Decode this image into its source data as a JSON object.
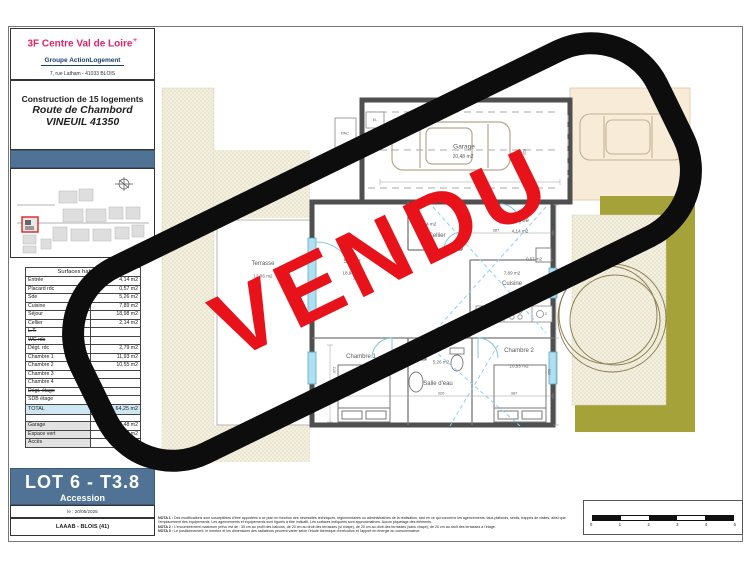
{
  "header": {
    "brand": "3F Centre Val de Loire",
    "brand_mark": "✳",
    "group": "Groupe ActionLogement",
    "address": "7, rue Latham - 41033 BLOIS",
    "project_line1": "Construction de 15 logements",
    "project_line2": "Route de Chambord",
    "project_line3": "VINEUIL 41350"
  },
  "surfaces": {
    "title": "Surfaces habitables",
    "rows": [
      {
        "label": "Entrée",
        "value": "4,14 m2",
        "struck": false
      },
      {
        "label": "Placard rdc",
        "value": "0,57 m2",
        "struck": false
      },
      {
        "label": "Sde",
        "value": "5,26 m2",
        "struck": false
      },
      {
        "label": "Cuisine",
        "value": "7,89 m2",
        "struck": false
      },
      {
        "label": "Séjour",
        "value": "18,98 m2",
        "struck": false
      },
      {
        "label": "Cellier",
        "value": "2,14 m2",
        "struck": false
      },
      {
        "label": "L.T.",
        "value": "",
        "struck": true
      },
      {
        "label": "WC rdc",
        "value": "",
        "struck": true
      },
      {
        "label": "Dégt. rdc",
        "value": "2,79 m2",
        "struck": false
      },
      {
        "label": "Chambre 1",
        "value": "11,93 m2",
        "struck": false
      },
      {
        "label": "Chambre 2",
        "value": "10,55 m2",
        "struck": false
      },
      {
        "label": "Chambre 3",
        "value": "",
        "struck": false
      },
      {
        "label": "Chambre 4",
        "value": "",
        "struck": false
      },
      {
        "label": "Dégt. étage",
        "value": "",
        "struck": true
      },
      {
        "label": "SDB étage",
        "value": "",
        "struck": false
      },
      {
        "label": "WC étage",
        "value": "",
        "struck": false
      },
      {
        "label": "",
        "value": "",
        "struck": false
      }
    ],
    "total_label": "TOTAL",
    "total_value": "64,25 m2",
    "annex": [
      {
        "label": "Garage",
        "value": "20,48 m2"
      },
      {
        "label": "Espace vert",
        "value": "82,6 m2"
      },
      {
        "label": "Accès",
        "value": "19,38 m2"
      }
    ]
  },
  "lot": {
    "title": "LOT 6 - T3.8",
    "subtitle": "Accession",
    "date": "le : 20/05/2025",
    "ref": "LAAAB - BLOIS (41)"
  },
  "stamp": {
    "text": "VENDU",
    "text_color": "#e8121a",
    "border_color": "#0d0d0d"
  },
  "plan": {
    "labels": [
      {
        "id": "garage-name",
        "text": "Garage",
        "x": 464,
        "y": 147,
        "size": 6.5
      },
      {
        "id": "garage-area",
        "text": "20,48 m2",
        "x": 463,
        "y": 157,
        "size": 5
      },
      {
        "id": "pac",
        "text": "PAC",
        "x": 345,
        "y": 133,
        "size": 4
      },
      {
        "id": "el",
        "text": "EL",
        "x": 375,
        "y": 120,
        "size": 3.5
      },
      {
        "id": "cellier-area",
        "text": "2,14 m2",
        "x": 428,
        "y": 224,
        "size": 4.6
      },
      {
        "id": "cellier-name",
        "text": "Cellier",
        "x": 437,
        "y": 236,
        "size": 6
      },
      {
        "id": "entree-name",
        "text": "Entrée",
        "x": 520,
        "y": 221,
        "size": 6
      },
      {
        "id": "entree-area",
        "text": "4,14 m2",
        "x": 520,
        "y": 231,
        "size": 4.6
      },
      {
        "id": "placard-area",
        "text": "0,57 m2",
        "x": 534,
        "y": 259,
        "size": 4.4
      },
      {
        "id": "cuisine-area",
        "text": "7,89 m2",
        "x": 512,
        "y": 273,
        "size": 4.6
      },
      {
        "id": "cuisine-name",
        "text": "Cuisine",
        "x": 512,
        "y": 284,
        "size": 6
      },
      {
        "id": "sejour-name",
        "text": "Séjour",
        "x": 352,
        "y": 262,
        "size": 6
      },
      {
        "id": "sejour-area",
        "text": "18,98 m2",
        "x": 352,
        "y": 273,
        "size": 4.6
      },
      {
        "id": "terrasse-name",
        "text": "Terrasse",
        "x": 263,
        "y": 264,
        "size": 6
      },
      {
        "id": "terrasse-area",
        "text": "12,06 m2",
        "x": 263,
        "y": 276,
        "size": 4.6
      },
      {
        "id": "degt-area",
        "text": "2,79 m2",
        "x": 443,
        "y": 330,
        "size": 4.6
      },
      {
        "id": "degt-name",
        "text": "Dégt.",
        "x": 443,
        "y": 341,
        "size": 6
      },
      {
        "id": "chambre1-name",
        "text": "Chambre 1",
        "x": 361,
        "y": 357,
        "size": 6
      },
      {
        "id": "chambre1-area",
        "text": "11,93 m2",
        "x": 359,
        "y": 377,
        "size": 4.6
      },
      {
        "id": "sde-area",
        "text": "5,26 m2",
        "x": 441,
        "y": 362,
        "size": 4.6
      },
      {
        "id": "sde-name",
        "text": "Salle d'eau",
        "x": 438,
        "y": 384,
        "size": 6
      },
      {
        "id": "chambre2-name",
        "text": "Chambre 2",
        "x": 519,
        "y": 351,
        "size": 6
      },
      {
        "id": "chambre2-area",
        "text": "10,55 m2",
        "x": 519,
        "y": 366,
        "size": 4.6
      },
      {
        "id": "appl-r",
        "text": "R",
        "x": 482,
        "y": 314,
        "size": 3.5
      },
      {
        "id": "appl-lv",
        "text": "LV",
        "x": 496,
        "y": 314,
        "size": 3.5
      },
      {
        "id": "appl-c",
        "text": "C",
        "x": 546,
        "y": 314,
        "size": 3.5
      },
      {
        "id": "dim-628",
        "text": "628",
        "x": 478,
        "y": 177,
        "size": 4
      },
      {
        "id": "dim-387-top",
        "text": "387",
        "x": 496,
        "y": 230,
        "size": 4
      },
      {
        "id": "dim-326",
        "text": "326",
        "x": 346,
        "y": 393,
        "size": 4
      },
      {
        "id": "dim-320",
        "text": "320",
        "x": 441,
        "y": 393,
        "size": 4
      },
      {
        "id": "dim-387-bot",
        "text": "387",
        "x": 514,
        "y": 393,
        "size": 4
      },
      {
        "id": "dim-372",
        "text": "372",
        "x": 334,
        "y": 370,
        "size": 4,
        "rot": true
      },
      {
        "id": "dim-358",
        "text": "358",
        "x": 549,
        "y": 372,
        "size": 4,
        "rot": true
      },
      {
        "id": "dim-214",
        "text": "214",
        "x": 548,
        "y": 288,
        "size": 4,
        "rot": true
      },
      {
        "id": "dim-328",
        "text": "328",
        "x": 524,
        "y": 152,
        "size": 4,
        "rot": true
      }
    ]
  },
  "notes": [
    {
      "label": "NOTA 1 :",
      "text": " Des modifications sont susceptibles d'être apportées à ce plan en fonction des nécessités techniques, réglementaires ou administratives de la réalisation, tant en ce qui concerne les agencements, faux-plafonds, seuils, trappes de visites, ainsi que l'emplacement des équipements. Les agencements et équipements sont figurés à titre indicatif. Les surfaces indiquées sont approximatives. Aucun piquetage des éléments."
    },
    {
      "label": "NOTA 2 :",
      "text": " L'encombrement maximum prévu est de : 35 cm au profil des balcons, de 20 cm au droit des terrasses (si chape), de 20 cm au droit des terrasses (sans chape), de 20 cm au droit des terrasses à l'étage."
    },
    {
      "label": "NOTA 3 :",
      "text": " Le positionnement, le nombre et les dimensions des radiateurs peuvent varier selon l'étude thermique d'exécution et l'apport en énergie du consommateur."
    }
  ],
  "scale_bar": {
    "ticks": [
      "0",
      "1",
      "2",
      "3",
      "4",
      "5"
    ]
  },
  "colors": {
    "accent_blue": "#4f7295",
    "brand_pink": "#e0256d",
    "group_navy": "#1b3d6e",
    "stamp_red": "#e8121a",
    "stamp_black": "#0d0d0d",
    "total_highlight": "#cfe7f3",
    "olive_green": "#a5a239",
    "driveway_beige": "#f8ecd9",
    "wall_gray": "#4f4f4f",
    "window_blue": "#aee0f2"
  }
}
